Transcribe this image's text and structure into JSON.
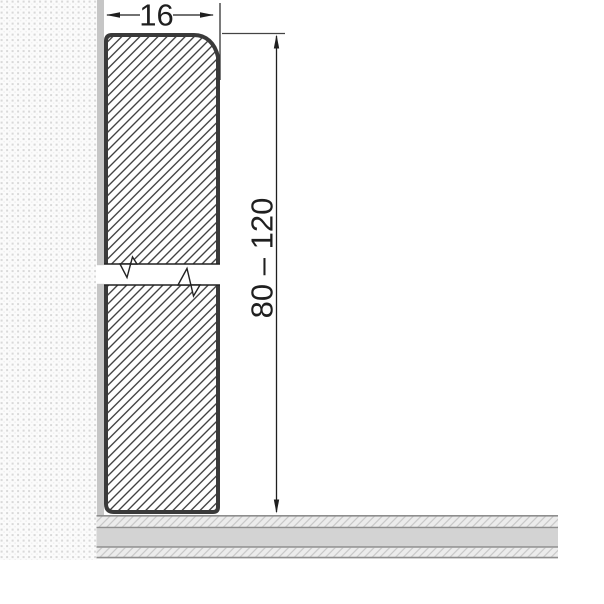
{
  "diagram": {
    "subject": "skirting-board-profile-cross-section",
    "width_dimension": {
      "label": "16"
    },
    "height_dimension": {
      "label": "80 – 120"
    },
    "colors": {
      "board_outline": "#3a3a3a",
      "board_hatch": "#2f2f2f",
      "wall_strip": "#c6c6c6",
      "wall_dot": "#d9d9d9",
      "floor_solid_band": "#d3d3d3",
      "floor_border_line": "#8e8e8e",
      "floor_hatch_bg": "#ececec",
      "dimension_line": "#1f1f1f"
    }
  }
}
